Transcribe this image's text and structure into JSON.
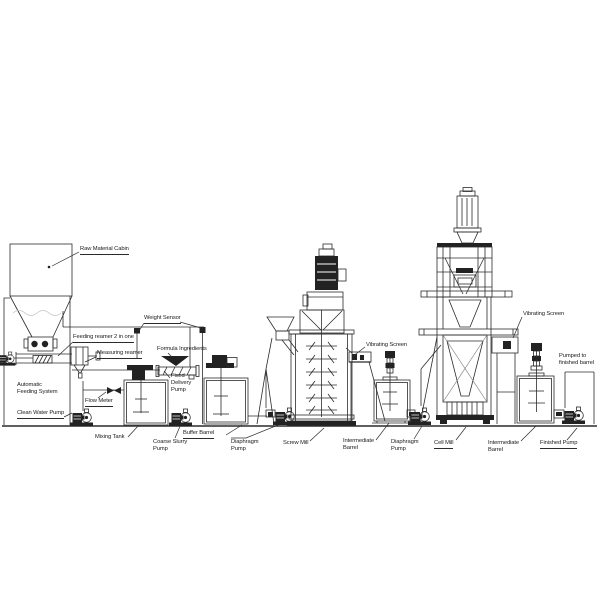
{
  "page": {
    "width": 600,
    "height": 600,
    "background": "#ffffff"
  },
  "diagram": {
    "type": "process-flow-schematic",
    "subject": "production line equipment schematic",
    "colors": {
      "line": "#2b2b2b",
      "dark_fill": "#222222",
      "text": "#1a1a1a",
      "background": "#ffffff",
      "material_wave": "#c4c4c4"
    },
    "labels": [
      {
        "id": "raw-material-cabin",
        "lines": [
          "Raw Material Cabin"
        ],
        "x": 80,
        "y": 246,
        "underline": true
      },
      {
        "id": "weight-sensor",
        "lines": [
          "Weight Sensor"
        ],
        "x": 144,
        "y": 315,
        "underline": true
      },
      {
        "id": "feeding-reamer",
        "lines": [
          "Feeding reamer 2 in one"
        ],
        "x": 73,
        "y": 334,
        "underline": true
      },
      {
        "id": "measuring-reamer",
        "lines": [
          "Measuring reamer"
        ],
        "x": 97,
        "y": 350,
        "underline": true
      },
      {
        "id": "formula-ingredients",
        "lines": [
          "Formula Ingredients"
        ],
        "x": 157,
        "y": 346,
        "underline": false
      },
      {
        "id": "fixed-delivery-pump",
        "lines": [
          "Fixed",
          "Delivery",
          "Pump"
        ],
        "x": 171,
        "y": 373,
        "underline": false
      },
      {
        "id": "automatic-feeding-system",
        "lines": [
          "Automatic",
          "Feeding System"
        ],
        "x": 17,
        "y": 382,
        "underline": false
      },
      {
        "id": "clean-water-pump",
        "lines": [
          "Clean Water Pump"
        ],
        "x": 17,
        "y": 410,
        "underline": true
      },
      {
        "id": "flow-meter",
        "lines": [
          "Flow Meter"
        ],
        "x": 85,
        "y": 398,
        "underline": true
      },
      {
        "id": "mixing-tank",
        "lines": [
          "Mixing Tank"
        ],
        "x": 95,
        "y": 434,
        "underline": false
      },
      {
        "id": "coarse-slurry-pump",
        "lines": [
          "Coarse Slurry",
          "Pump"
        ],
        "x": 153,
        "y": 439,
        "underline": false
      },
      {
        "id": "buffer-barrel",
        "lines": [
          "Buffer Barrel"
        ],
        "x": 183,
        "y": 430,
        "underline": true
      },
      {
        "id": "diaphragm-pump-1",
        "lines": [
          "Diaphragm",
          "Pump"
        ],
        "x": 231,
        "y": 439,
        "underline": false
      },
      {
        "id": "screw-mill",
        "lines": [
          "Screw Mill"
        ],
        "x": 283,
        "y": 440,
        "underline": false
      },
      {
        "id": "vibrating-screen-1",
        "lines": [
          "Vibrating Screen"
        ],
        "x": 366,
        "y": 342,
        "underline": false
      },
      {
        "id": "intermediate-barrel-1",
        "lines": [
          "Intermediate",
          "Barrel"
        ],
        "x": 343,
        "y": 438,
        "underline": false
      },
      {
        "id": "diaphragm-pump-2",
        "lines": [
          "Diaphragm",
          "Pump"
        ],
        "x": 391,
        "y": 439,
        "underline": false
      },
      {
        "id": "cell-mill",
        "lines": [
          "Cell Mill"
        ],
        "x": 434,
        "y": 440,
        "underline": true
      },
      {
        "id": "vibrating-screen-2",
        "lines": [
          "Vibrating Screen"
        ],
        "x": 523,
        "y": 311,
        "underline": false
      },
      {
        "id": "intermediate-barrel-2",
        "lines": [
          "Intermediate",
          "Barrel"
        ],
        "x": 488,
        "y": 440,
        "underline": false
      },
      {
        "id": "finished-pump",
        "lines": [
          "Finished Pump"
        ],
        "x": 540,
        "y": 440,
        "underline": true
      },
      {
        "id": "pumped-to-finished-barrel",
        "lines": [
          "Pumped to",
          "finished barrel"
        ],
        "x": 559,
        "y": 353,
        "underline": false
      }
    ]
  }
}
